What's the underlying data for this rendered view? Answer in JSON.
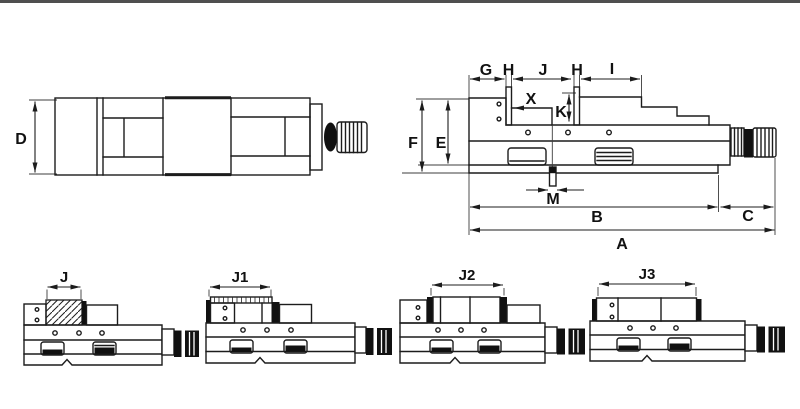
{
  "colors": {
    "background": "#ffffff",
    "line": "#1c1c1c",
    "top_bar": "#4f4f4f"
  },
  "top_view": {
    "labels": {
      "d": "D"
    }
  },
  "side_view": {
    "labels": {
      "g": "G",
      "h_left": "H",
      "j": "J",
      "h_right": "H",
      "i": "I",
      "x": "X",
      "k": "K",
      "f": "F",
      "e": "E",
      "m": "M",
      "b": "B",
      "c": "C",
      "a": "A"
    }
  },
  "variants": [
    {
      "label": "J"
    },
    {
      "label": "J1"
    },
    {
      "label": "J2"
    },
    {
      "label": "J3"
    }
  ]
}
